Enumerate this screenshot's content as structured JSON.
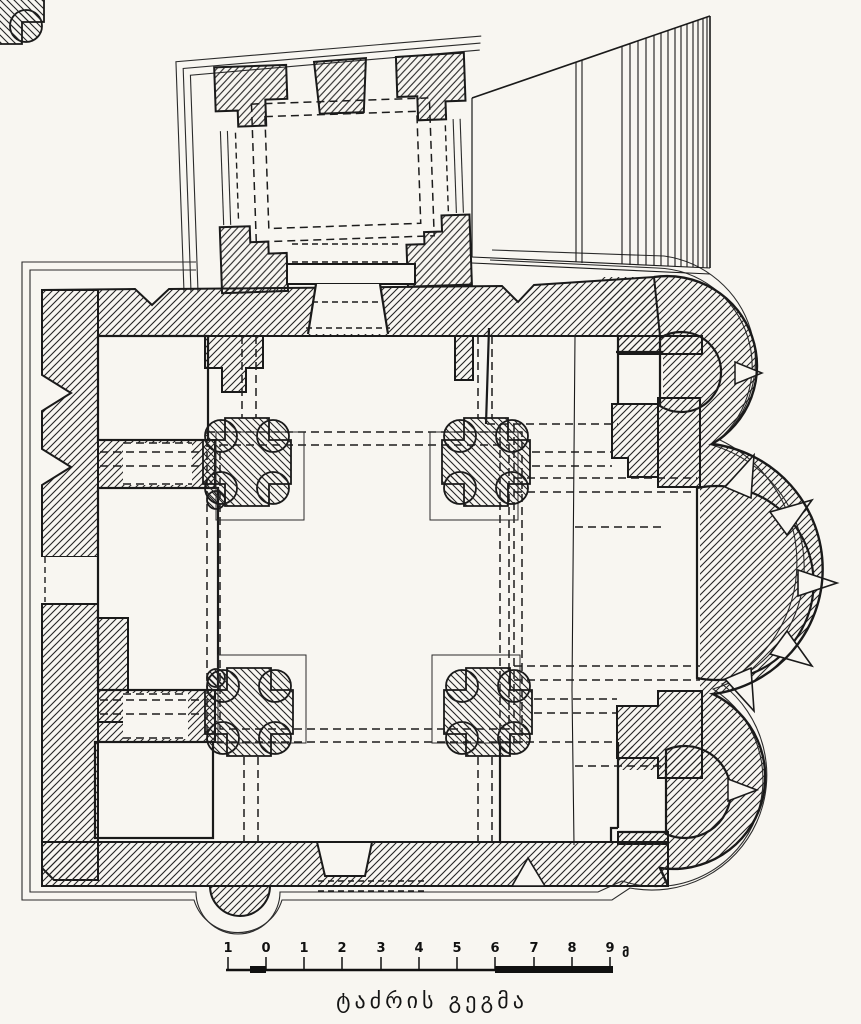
{
  "colors": {
    "paper": "#f8f6f1",
    "ink": "#1a1a1a"
  },
  "caption": {
    "text": "ტაძრის გეგმა"
  },
  "scale_bar": {
    "labels": [
      "1",
      "0",
      "1",
      "2",
      "3",
      "4",
      "5",
      "6",
      "7",
      "8",
      "9"
    ],
    "unit": "მ"
  }
}
